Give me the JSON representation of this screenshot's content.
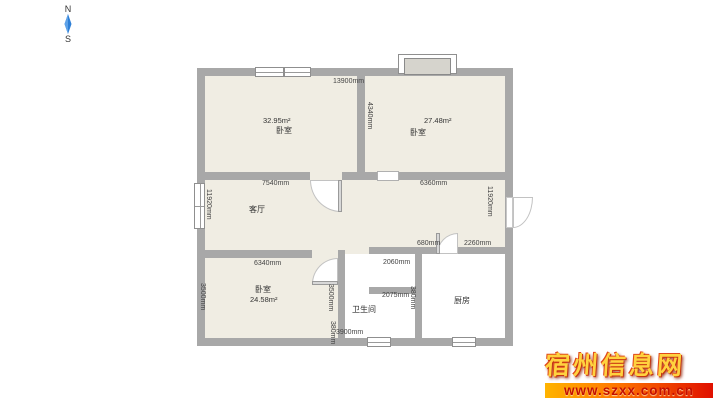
{
  "compass": {
    "north_label": "N",
    "south_label": "S"
  },
  "rooms": {
    "bedroom_nw": {
      "name": "卧室",
      "area": "32.95m²"
    },
    "bedroom_ne": {
      "name": "卧室",
      "area": "27.48m²"
    },
    "living_room": {
      "name": "客厅"
    },
    "bedroom_sw": {
      "name": "卧室",
      "area": "24.58m²"
    },
    "bathroom": {
      "name": "卫生间"
    },
    "kitchen": {
      "name": "厨房"
    }
  },
  "dimensions": {
    "top_width": "13900mm",
    "ne_divider_height": "4340mm",
    "nw_room_width": "7540mm",
    "ne_room_width": "6360mm",
    "left_height": "11920mm",
    "right_height": "11920mm",
    "kitchen_door_offset": "680mm",
    "kitchen_width": "2260mm",
    "hall_top_width": "2060mm",
    "bath_top_width": "2075mm",
    "sw_room_width": "6340mm",
    "sw_left_height": "3500mm",
    "sw_right_height": "3500mm",
    "sw_bottom_stub": "380mm",
    "bath_right_stub": "380mm",
    "bottom_width": "3900mm"
  },
  "watermark": {
    "site_name": "宿州信息网",
    "url": "www.szxx.com.cn"
  },
  "colors": {
    "wall": "#a8a8a8",
    "room_fill": "#f0ede3",
    "compass_needle": "#2e7fd6",
    "watermark_gold": "#ffd23f",
    "watermark_bar_start": "#ffb400",
    "watermark_bar_end": "#e01000"
  }
}
